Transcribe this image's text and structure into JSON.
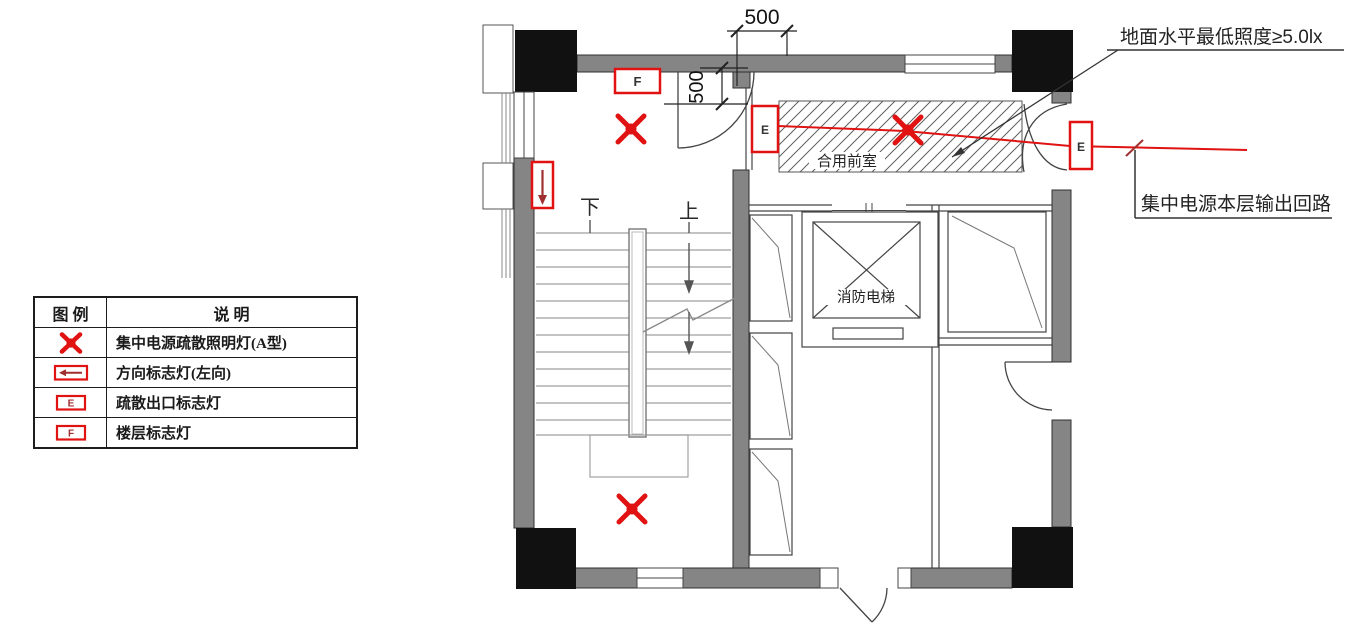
{
  "colors": {
    "symbol_red": "#e01212",
    "arrow_dark_red": "#a03030",
    "wall_gray": "#858585",
    "column_black": "#111111",
    "line_dark": "#333333"
  },
  "legend": {
    "header_symbol": "图 例",
    "header_description": "说  明",
    "rows": [
      {
        "symbol": "evac-light-x",
        "description": "集中电源疏散照明灯(A型)"
      },
      {
        "symbol": "direction-sign-left",
        "description": "方向标志灯(左向)"
      },
      {
        "symbol": "exit-sign-e",
        "letter": "E",
        "description": "疏散出口标志灯"
      },
      {
        "symbol": "floor-sign-f",
        "letter": "F",
        "description": "楼层标志灯"
      }
    ]
  },
  "plan": {
    "labels": {
      "stair_down": "下",
      "stair_up": "上",
      "fire_elevator": "消防电梯",
      "shared_lobby": "合用前室"
    },
    "dimensions": {
      "top": "500",
      "side": "500"
    },
    "letters": {
      "exit": "E",
      "floor": "F"
    }
  },
  "annotations": {
    "illuminance": "地面水平最低照度≥5.0lx",
    "circuit_output": "集中电源本层输出回路"
  }
}
